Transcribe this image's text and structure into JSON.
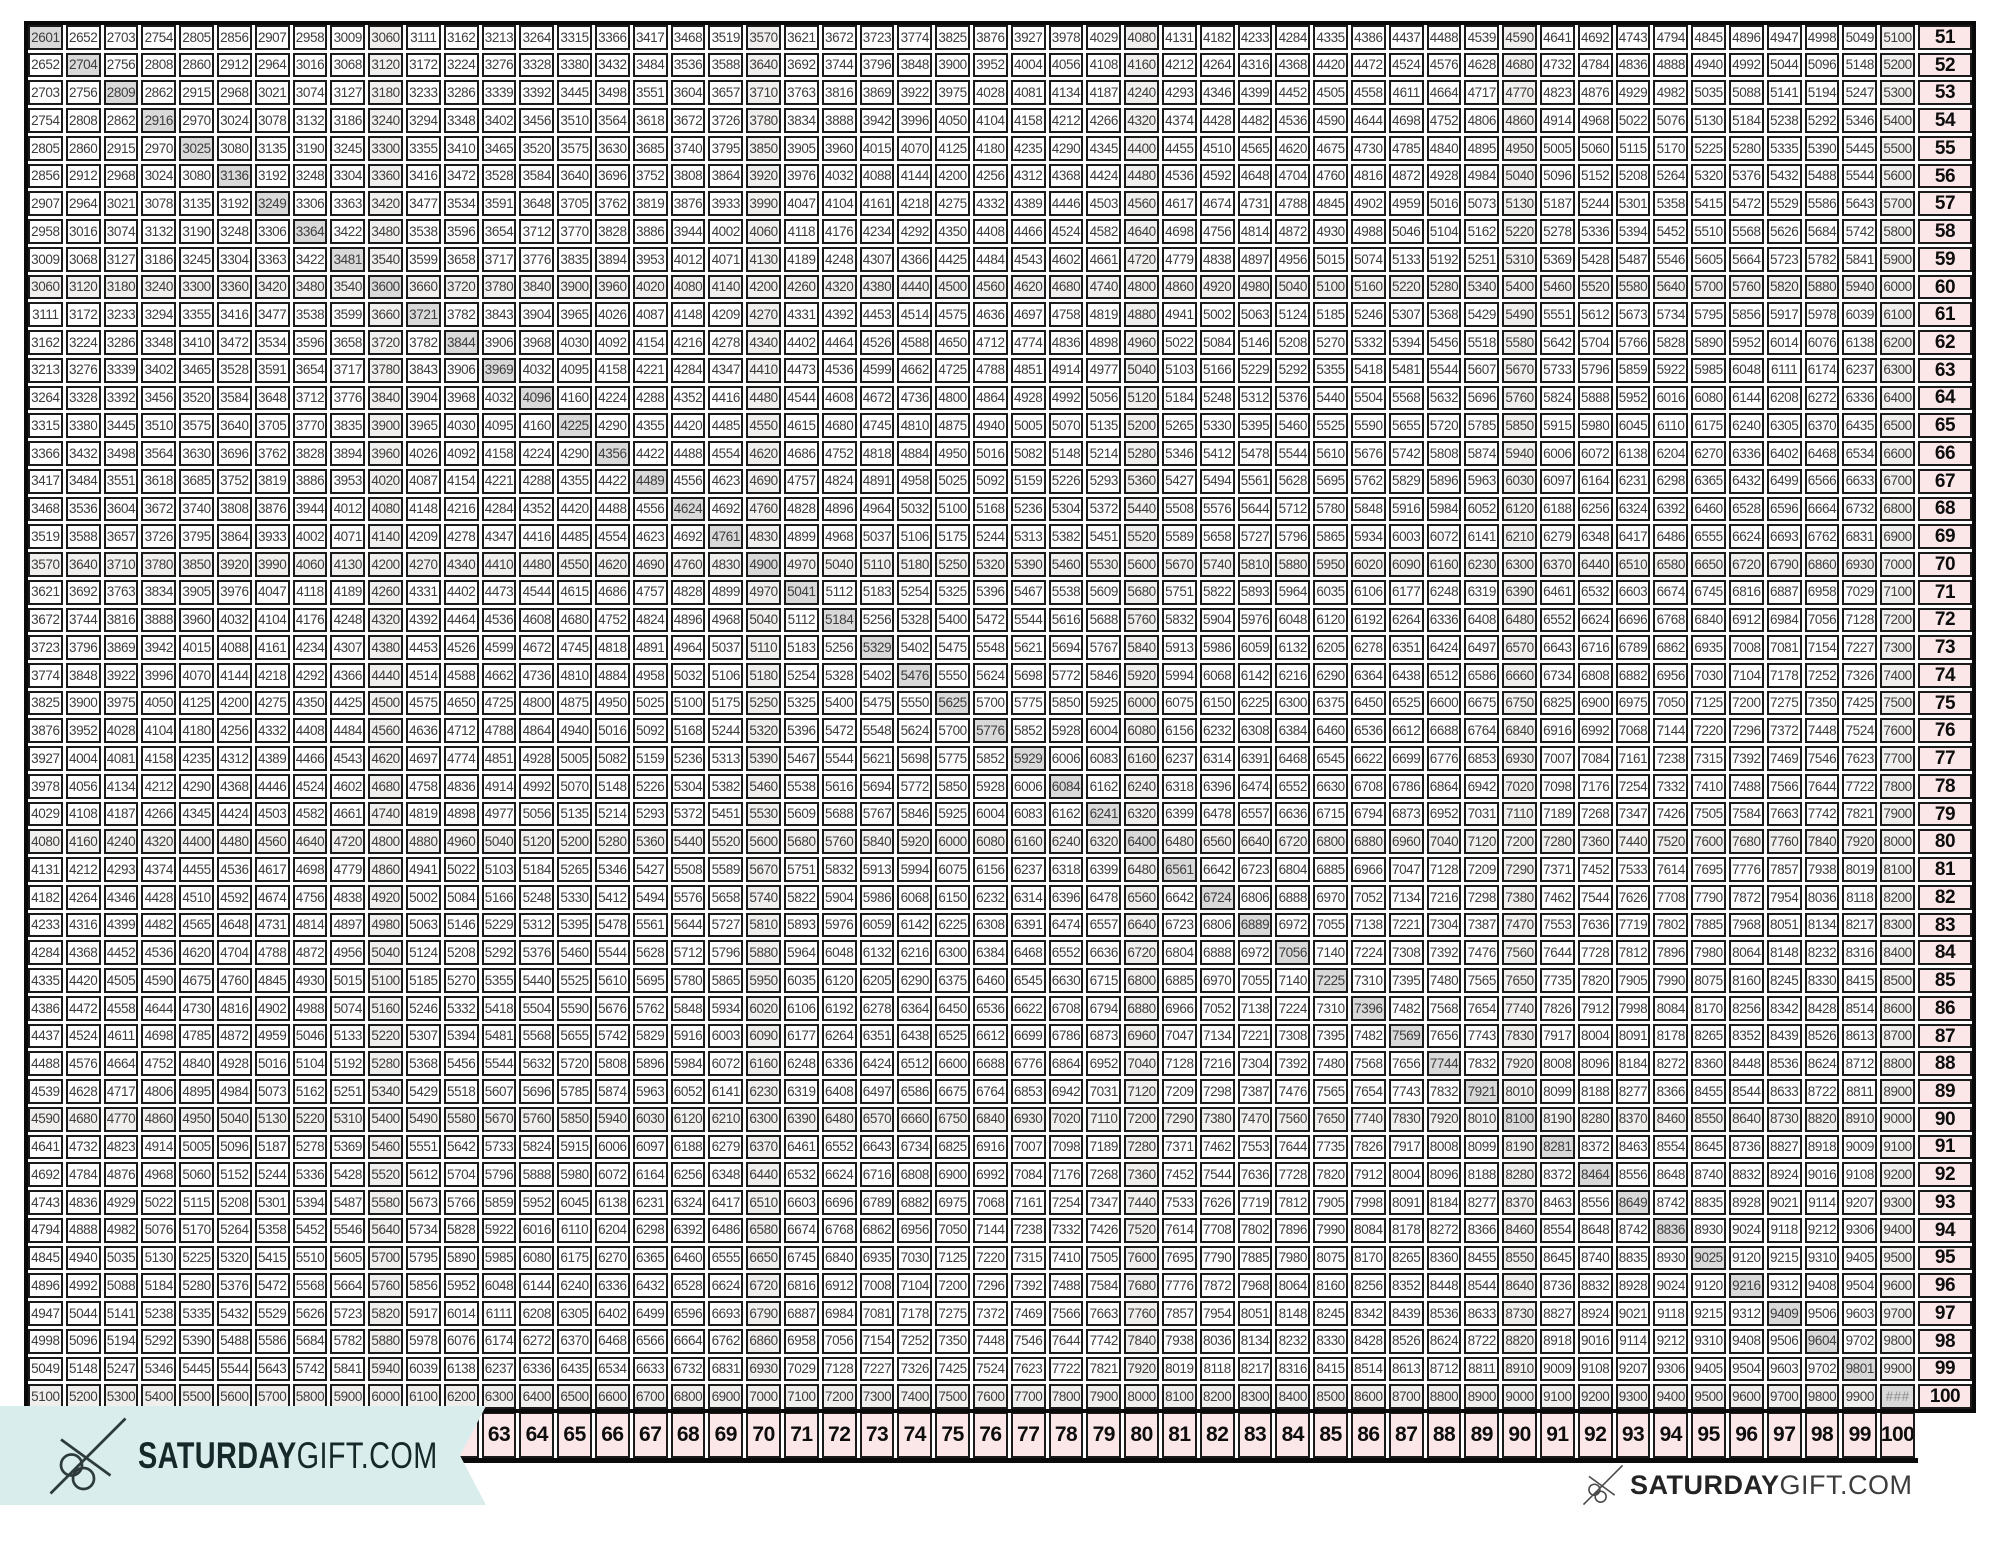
{
  "document": {
    "kind": "multiplication-chart-printable"
  },
  "table": {
    "row_start": 51,
    "row_end": 100,
    "col_start": 51,
    "col_end": 100,
    "cell_rule": "each cell shows the product of its row header and column header",
    "band_every": 10,
    "overflow_display": "###",
    "overflow_at": {
      "row": 100,
      "col": 100
    },
    "right_header_values": [
      51,
      52,
      53,
      54,
      55,
      56,
      57,
      58,
      59,
      60,
      61,
      62,
      63,
      64,
      65,
      66,
      67,
      68,
      69,
      70,
      71,
      72,
      73,
      74,
      75,
      76,
      77,
      78,
      79,
      80,
      81,
      82,
      83,
      84,
      85,
      86,
      87,
      88,
      89,
      90,
      91,
      92,
      93,
      94,
      95,
      96,
      97,
      98,
      99,
      100
    ],
    "bottom_header_values": [
      63,
      64,
      65,
      66,
      67,
      68,
      69,
      70,
      71,
      72,
      73,
      74,
      75,
      76,
      77,
      78,
      79,
      80,
      81,
      82,
      83,
      84,
      85,
      86,
      87,
      88,
      89,
      90,
      91,
      92,
      93,
      94,
      95,
      96,
      97,
      98,
      99,
      100
    ],
    "corner_sample_values": {
      "top_left": 2601,
      "top_right": 5100,
      "bottom_left": 5100,
      "bottom_right_display": "###"
    }
  },
  "colors": {
    "header_pink": "#fbe6e8",
    "square_highlight_gray": "#d9d9d9",
    "band_light_gray": "#f1efee",
    "banner_mint": "#d9edec",
    "border_black": "#1a1a1a",
    "cell_text_gray": "#3c3c3c",
    "overflow_text_gray": "#8e8e8e"
  },
  "branding": {
    "left_banner": {
      "bold": "SATURDAY",
      "light": "GIFT.COM",
      "icon": "scissors"
    },
    "right_footer": {
      "bold": "SATURDAY",
      "light": "GIFT.COM",
      "icon": "scissors"
    }
  }
}
